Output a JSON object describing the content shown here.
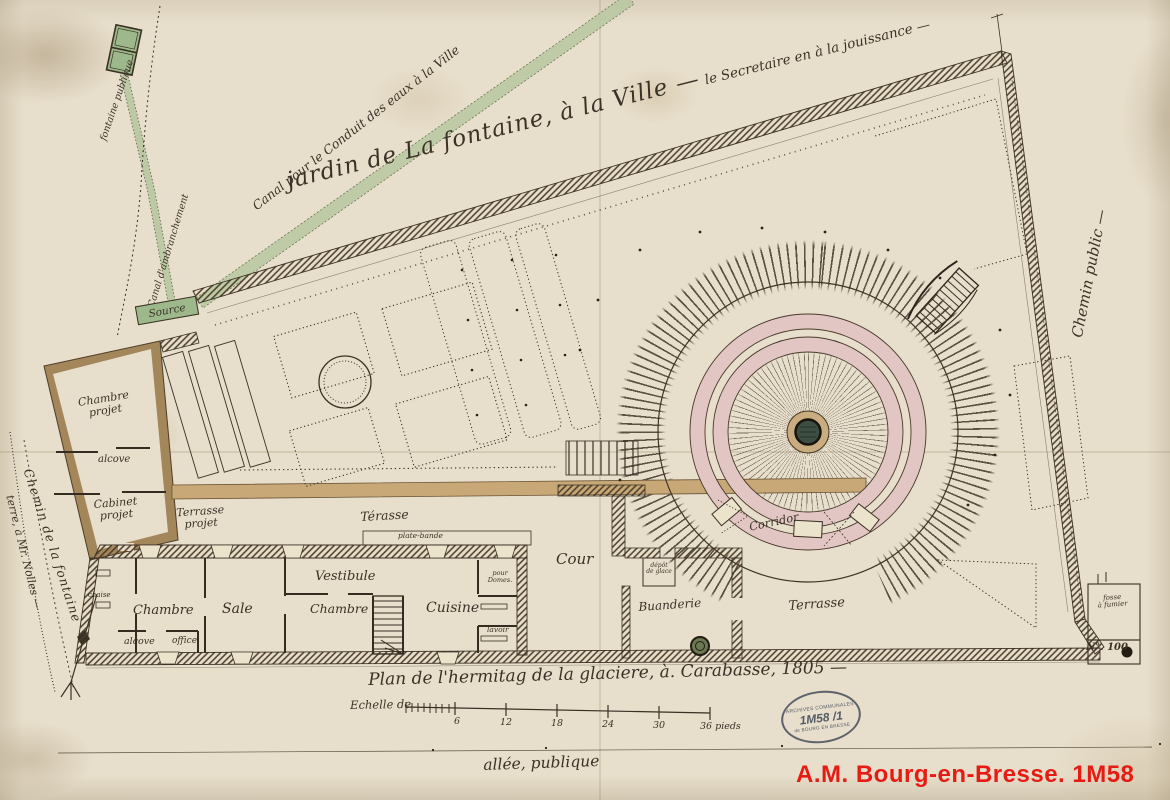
{
  "labels": {
    "canal_conduit": "Canal pour le Conduit des eaux à la Ville",
    "jardin_main": "jardin de La fontaine, à la Ville —",
    "jardin_sub": "le Secretaire en à la jouissance —",
    "chemin_public": "Chemin public —",
    "fontaine_publique": "fontaine publique",
    "canal_embranchement": "Canal d'ambranchement",
    "source": "Source",
    "chemin_fontaine": "Chemin de la fontaine",
    "terre_nollet": "terre, à Mr. Nolles —",
    "allee_publique": "allée, publique",
    "plan_title": "Plan de l'hermitag de la glaciere, à. Carabasse, 1805 —",
    "echelle": "Echelle de",
    "cour": "Cour",
    "corridor": "Corridor",
    "terrasse": "Terrasse",
    "buanderie": "Buanderie",
    "depot_glace_1": "dépôt",
    "depot_glace_2": "de glace",
    "fosse_fumier_1": "fosse",
    "fosse_fumier_2": "à fumier",
    "no100": "N°. 100"
  },
  "rooms": {
    "chaise": "chaise",
    "chambre1": "Chambre",
    "alcove1": "alcove",
    "office": "office",
    "sale": "Sale",
    "vestibule": "Vestibule",
    "chambre2": "Chambre",
    "cuisine": "Cuisine",
    "pour_dom_1": "pour",
    "pour_dom_2": "Domes.",
    "lavoir": "lavoir",
    "chambre_projet_1": "Chambre",
    "chambre_projet_2": "projet",
    "alcove2": "alcove",
    "cabinet_projet_1": "Cabinet",
    "cabinet_projet_2": "projet",
    "terrasse_projet_1": "Terrasse",
    "terrasse_projet_2": "projet",
    "terasse2": "Térasse",
    "plate_bande": "plate-bande"
  },
  "scale": {
    "ticks": [
      "6",
      "12",
      "18",
      "24",
      "30",
      "36 pieds"
    ]
  },
  "stamp": {
    "line1": "ARCHIVES COMMUNALES",
    "line2": "1M58 /1",
    "line3": "de BOURG EN BRESSE"
  },
  "footer": {
    "reference": "A.M. Bourg-en-Bresse. 1M58"
  },
  "colors": {
    "paper": "#e7decb",
    "ink": "#3b3226",
    "canal_green": "#b7c7a0",
    "wall_tan": "#a3865a",
    "ring_pink": "#e2c6c3",
    "reference_red": "#e61c14",
    "stamp_blue": "#444e5a"
  }
}
